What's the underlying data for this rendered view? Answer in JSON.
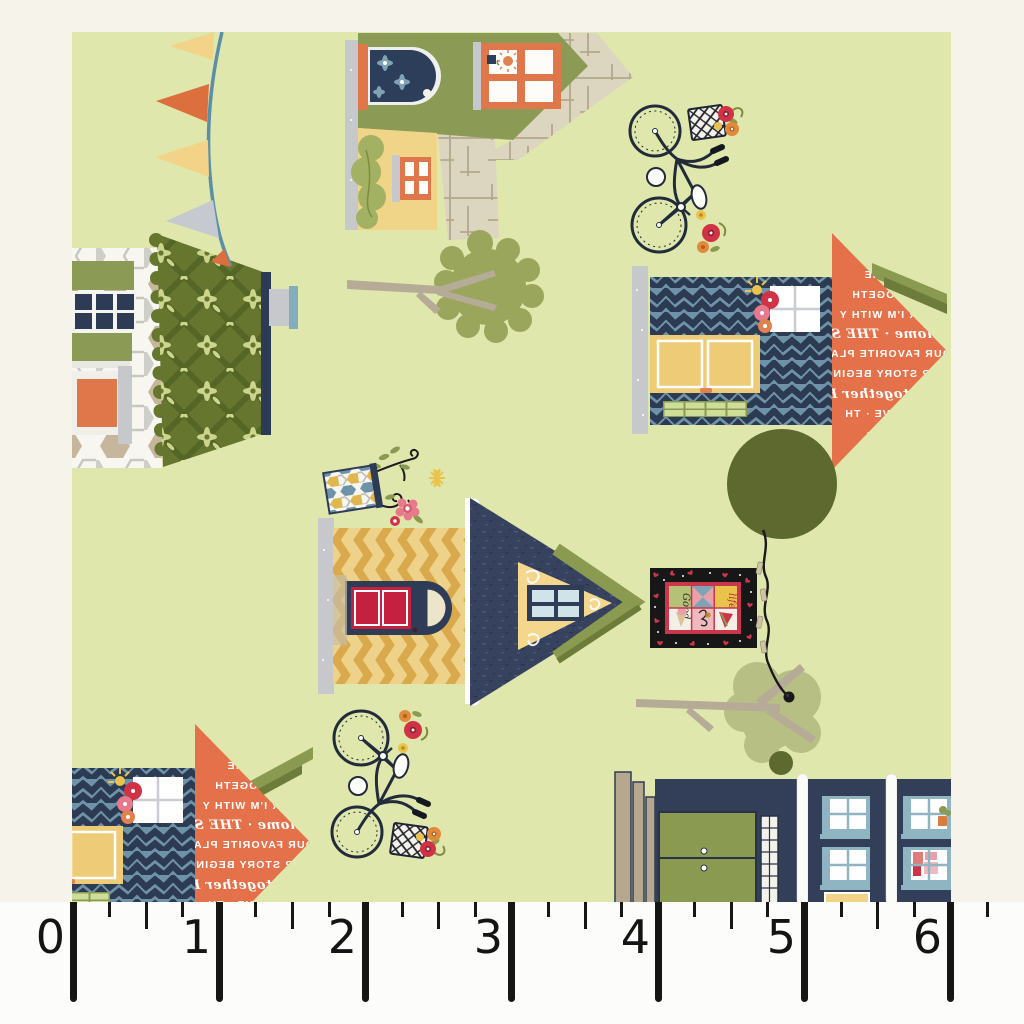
{
  "scene": {
    "motifs": [
      "bunting-flags",
      "cottage-with-arched-window",
      "bicycle-with-flower-basket",
      "cottage-with-floral-roof",
      "cottage-with-text-print-roof",
      "cottage-with-red-door",
      "birdhouse-with-flowers",
      "mini-quilt-on-clothesline",
      "round-tree",
      "branch-tree",
      "storefront-row"
    ]
  },
  "roof_text": {
    "lines": [
      "WH",
      "· HOME",
      "LL TOGETH",
      "VER I'M WITH Y",
      "T home · THE SE",
      "OUR FAVORITE PLAC",
      "OUR STORY BEGINS",
      "BUT together H",
      "E · LOVE · TH",
      "LACE ·",
      "VE ·",
      "CE"
    ]
  },
  "quilt": {
    "words": [
      "Good",
      "life"
    ]
  },
  "ruler": {
    "numbers": [
      "0",
      "1",
      "2",
      "3",
      "4",
      "5",
      "6"
    ],
    "background": "#fcfcfb",
    "tick_color": "#161616"
  },
  "colors": {
    "fabric_background": "#dfe7ad",
    "photo_border": "#f5f3ea",
    "navy": "#2e3b55",
    "navy_roof": "#36425e",
    "steel_blue": "#6e93a8",
    "olive": "#8b9b55",
    "dark_olive_tree": "#5d692e",
    "floral_roof_green": "#66762f",
    "orange": "#e0774a",
    "text_roof_coral": "#e5714a",
    "flag_orange": "#dd6e3e",
    "yellow": "#f0d488",
    "mustard": "#d9a94c",
    "red_door": "#c5203f",
    "flower_red": "#cf3345",
    "flower_pink": "#e8798c",
    "tan": "#b5a88f",
    "crosshatch_cream": "#dcd5bf",
    "gray": "#c6c8cb",
    "tree_sage": "#b7bf85",
    "branch_tan": "#b5ab96",
    "string_blue": "#5b8fa8"
  }
}
